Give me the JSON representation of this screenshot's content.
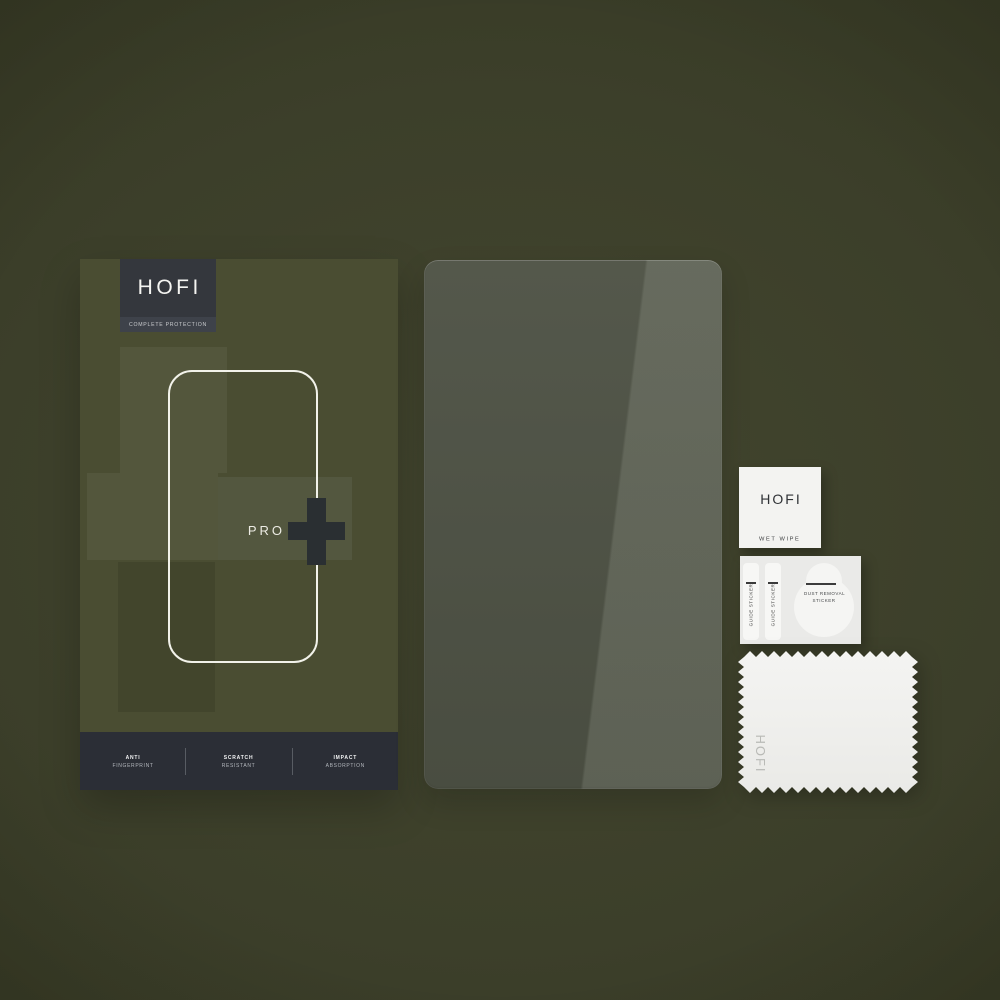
{
  "box": {
    "brand": "HOFI",
    "tagline": "COMPLETE PROTECTION",
    "model": "PRO",
    "plus_icon": "plus-cross",
    "features": [
      {
        "line1": "ANTI",
        "line2": "FINGERPRINT"
      },
      {
        "line1": "SCRATCH",
        "line2": "RESISTANT"
      },
      {
        "line1": "IMPACT",
        "line2": "ABSORPTION"
      }
    ]
  },
  "accessories": {
    "wet_wipe": {
      "brand": "HOFI",
      "label": "WET WIPE"
    },
    "sticker_card": {
      "guide_stickers": [
        "GUIDE STICKER",
        "GUIDE STICKER"
      ],
      "dust_removal_line1": "DUST REMOVAL",
      "dust_removal_line2": "STICKER"
    },
    "cloth": {
      "brand": "HOFI"
    }
  },
  "colors": {
    "background_olive": "#3c3f2a",
    "box_olive": "#4a4d32",
    "label_charcoal": "#34373d",
    "band_charcoal": "#2b2e36",
    "plus_charcoal": "#2a2f32",
    "glass_green": "#4d5144",
    "paper_white": "#f2f2f0"
  }
}
